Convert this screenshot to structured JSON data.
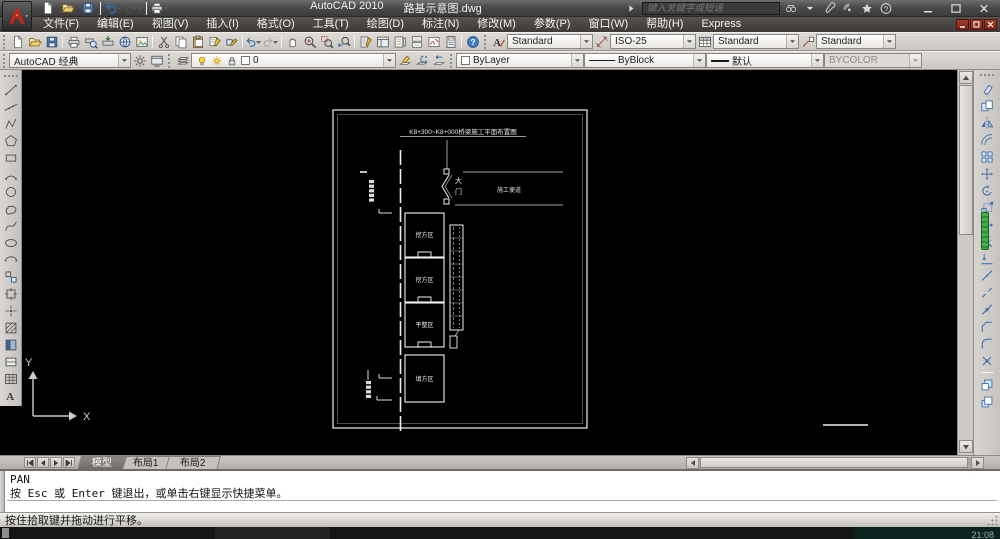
{
  "window": {
    "app_title": "AutoCAD 2010",
    "doc_title": "路基示意图.dwg",
    "search_placeholder": "键入关键字或短语"
  },
  "menubar": {
    "items": [
      "文件(F)",
      "编辑(E)",
      "视图(V)",
      "插入(I)",
      "格式(O)",
      "工具(T)",
      "绘图(D)",
      "标注(N)",
      "修改(M)",
      "参数(P)",
      "窗口(W)",
      "帮助(H)",
      "Express"
    ]
  },
  "toolbars": {
    "qat": {
      "items": [
        {
          "n": "qnew-button",
          "i": "new"
        },
        {
          "n": "open-button",
          "i": "open"
        },
        {
          "n": "save-button",
          "i": "save"
        },
        "|",
        {
          "n": "undo-button",
          "i": "undo",
          "d": 1
        },
        {
          "n": "redo-button",
          "i": "redo",
          "d": 1,
          "x": 1
        },
        "|",
        {
          "n": "plot-button",
          "i": "print",
          "d": 1
        }
      ]
    },
    "standard": {
      "items": [
        {
          "n": "qnew-button",
          "i": "new"
        },
        {
          "n": "open-button",
          "i": "open"
        },
        {
          "n": "save-button",
          "i": "save"
        },
        "|",
        {
          "n": "plot-button",
          "i": "print"
        },
        {
          "n": "plot-preview-button",
          "i": "preview"
        },
        {
          "n": "publish-button",
          "i": "publish"
        },
        {
          "n": "3ddwf-button",
          "i": "globe"
        },
        {
          "n": "export-image-button",
          "i": "image"
        },
        "|",
        {
          "n": "cut-button",
          "i": "cut"
        },
        {
          "n": "copy-clip-button",
          "i": "copydoc"
        },
        {
          "n": "paste-button",
          "i": "paste"
        },
        {
          "n": "match-properties-button",
          "i": "match"
        },
        {
          "n": "block-editor-button",
          "i": "blockedit"
        },
        "|",
        {
          "n": "undo-button",
          "i": "undo",
          "d": 1
        },
        {
          "n": "redo-button",
          "i": "redo",
          "d": 1,
          "x": 1
        },
        "|",
        {
          "n": "pan-realtime-button",
          "i": "pan"
        },
        {
          "n": "zoom-realtime-button",
          "i": "zoom"
        },
        {
          "n": "zoom-window-button",
          "i": "zoomwin"
        },
        {
          "n": "zoom-previous-button",
          "i": "zoomprev"
        },
        "|",
        {
          "n": "properties-palette-button",
          "i": "props"
        },
        {
          "n": "designcenter-button",
          "i": "designcenter"
        },
        {
          "n": "tool-palettes-button",
          "i": "palettes"
        },
        {
          "n": "sheetset-manager-button",
          "i": "sheetset"
        },
        {
          "n": "markup-manager-button",
          "i": "markup"
        },
        {
          "n": "quickcalc-button",
          "i": "calc"
        },
        "|",
        {
          "n": "help-button",
          "i": "help"
        }
      ]
    },
    "styles": {
      "text_style": "Standard",
      "dim_style": "ISO-25",
      "table_style": "Standard",
      "mleader_style": "Standard"
    },
    "workspace": {
      "value": "AutoCAD 经典"
    },
    "layers": {
      "current_layer": "0"
    },
    "properties": {
      "color": "ByLayer",
      "linetype": "ByBlock",
      "lineweight": "默认",
      "plot_style": "BYCOLOR"
    }
  },
  "draw_toolbar": {
    "items": [
      {
        "n": "line-tool",
        "i": "line"
      },
      {
        "n": "xline-tool",
        "i": "xline"
      },
      {
        "n": "polyline-tool",
        "i": "pline"
      },
      {
        "n": "polygon-tool",
        "i": "polygon"
      },
      {
        "n": "rectangle-tool",
        "i": "rectangle"
      },
      {
        "n": "arc-tool",
        "i": "arc"
      },
      {
        "n": "circle-tool",
        "i": "circle"
      },
      {
        "n": "revcloud-tool",
        "i": "revcloud"
      },
      {
        "n": "spline-tool",
        "i": "spline"
      },
      {
        "n": "ellipse-tool",
        "i": "ellipse"
      },
      {
        "n": "ellipse-arc-tool",
        "i": "earc"
      },
      {
        "n": "insert-block-tool",
        "i": "insblock"
      },
      {
        "n": "make-block-tool",
        "i": "mkblock"
      },
      {
        "n": "point-tool",
        "i": "point"
      },
      {
        "n": "hatch-tool",
        "i": "hatch"
      },
      {
        "n": "gradient-tool",
        "i": "gradient"
      },
      {
        "n": "region-tool",
        "i": "region"
      },
      {
        "n": "table-tool",
        "i": "tabletool"
      },
      {
        "n": "mtext-tool",
        "i": "mtext"
      }
    ]
  },
  "modify_toolbar": {
    "items": [
      {
        "n": "erase-tool",
        "i": "erase"
      },
      {
        "n": "copy-tool",
        "i": "mcopy"
      },
      {
        "n": "mirror-tool",
        "i": "mirror"
      },
      {
        "n": "offset-tool",
        "i": "offset"
      },
      {
        "n": "array-tool",
        "i": "array"
      },
      {
        "n": "move-tool",
        "i": "move"
      },
      {
        "n": "rotate-tool",
        "i": "rotate"
      },
      {
        "n": "scale-tool",
        "i": "scale"
      },
      {
        "n": "stretch-tool",
        "i": "stretch"
      },
      {
        "n": "trim-tool",
        "i": "trim"
      },
      {
        "n": "extend-tool",
        "i": "extend"
      },
      {
        "n": "break-at-point-tool",
        "i": "breakpt"
      },
      {
        "n": "break-tool",
        "i": "break"
      },
      {
        "n": "join-tool",
        "i": "join"
      },
      {
        "n": "chamfer-tool",
        "i": "chamfer"
      },
      {
        "n": "fillet-tool",
        "i": "fillet"
      },
      {
        "n": "explode-tool",
        "i": "explode"
      },
      "|",
      {
        "n": "bring-to-front-tool",
        "i": "dwofront"
      },
      {
        "n": "send-to-back-tool",
        "i": "dwoback"
      }
    ]
  },
  "drawing": {
    "title": "K8+300~K8+000桥梁施工平面布置图",
    "gate_char1": "大",
    "gate_char2": "门",
    "road_label": "施工便道",
    "zones": [
      "挖方区",
      "挖方区",
      "平整区",
      "填方区"
    ],
    "axis_y": "Y",
    "axis_x": "X"
  },
  "tabs": {
    "items": [
      {
        "key": "model",
        "label": "模型",
        "active": true
      },
      {
        "key": "layout1",
        "label": "布局1",
        "active": false
      },
      {
        "key": "layout2",
        "label": "布局2",
        "active": false
      }
    ]
  },
  "command": {
    "history": [
      "PAN",
      "按 Esc 或 Enter 键退出，或单击右键显示快捷菜单。"
    ],
    "input": ""
  },
  "statusbar": {
    "message": "按住拾取键并拖动进行平移。"
  },
  "taskbar": {
    "clock": "21:08"
  },
  "colors": {
    "canvas_bg": "#000000",
    "toolbar_bg": "#d0cdc9",
    "titlebar_bg": "#4b4b4b",
    "accent_red": "#c0271c",
    "dock_indicator_green": "#3fae49",
    "command_bg": "#ffffff",
    "modify_icon_blue": "#3b6cae"
  }
}
